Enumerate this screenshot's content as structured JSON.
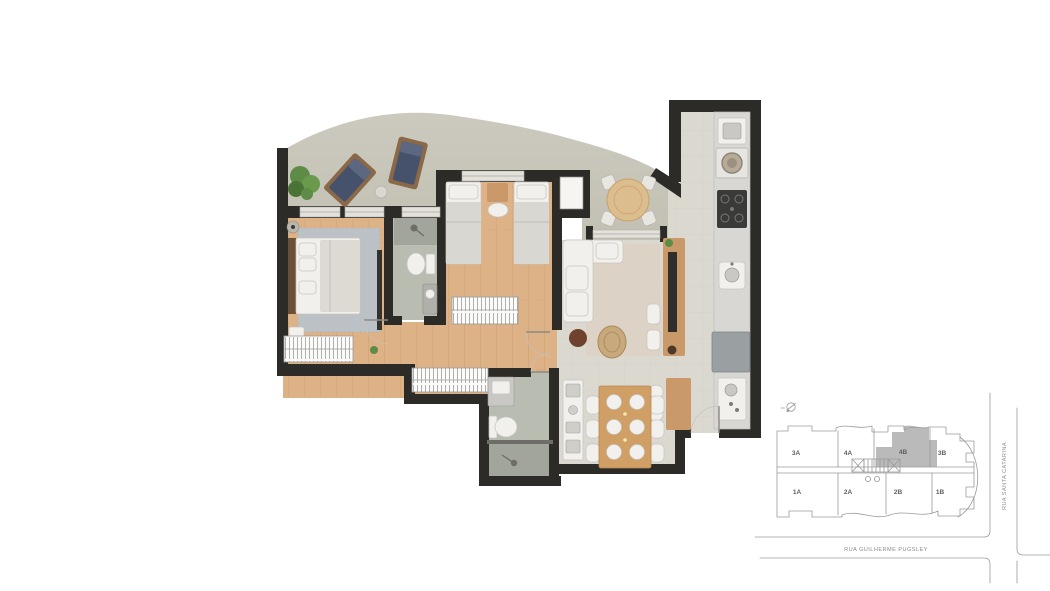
{
  "key_plan": {
    "units": [
      "3A",
      "4A",
      "4B",
      "3B",
      "1A",
      "2A",
      "2B",
      "1B"
    ],
    "highlighted_unit": "4B",
    "streets": {
      "bottom": "RUA GUILHERME PUGSLEY",
      "right": "RUA SANTA CATARINA"
    },
    "compass_icon": "north-arrow"
  },
  "colors": {
    "wall": "#2d2b28",
    "wood-floor": "#ddb286",
    "wood-floor-line": "#c3925f",
    "tile-floor": "#dbd8d0",
    "terrace-floor": "#c9c7bb",
    "bath-floor": "#b8bcb1",
    "shower-floor": "#a2a59c",
    "rug-gray": "#bcc1c6",
    "rug-beige": "#dcd3c6",
    "navy-cushion": "#46526c",
    "wood-furniture": "#c9996a",
    "white-furniture": "#f1f0ec",
    "appliance-gray": "#9aa0a2",
    "plant-green": "#5d8c46",
    "keyplan-line": "#9a9a9a",
    "keyplan-highlight": "#bababa",
    "keyplan-text": "#5f5f5f"
  }
}
